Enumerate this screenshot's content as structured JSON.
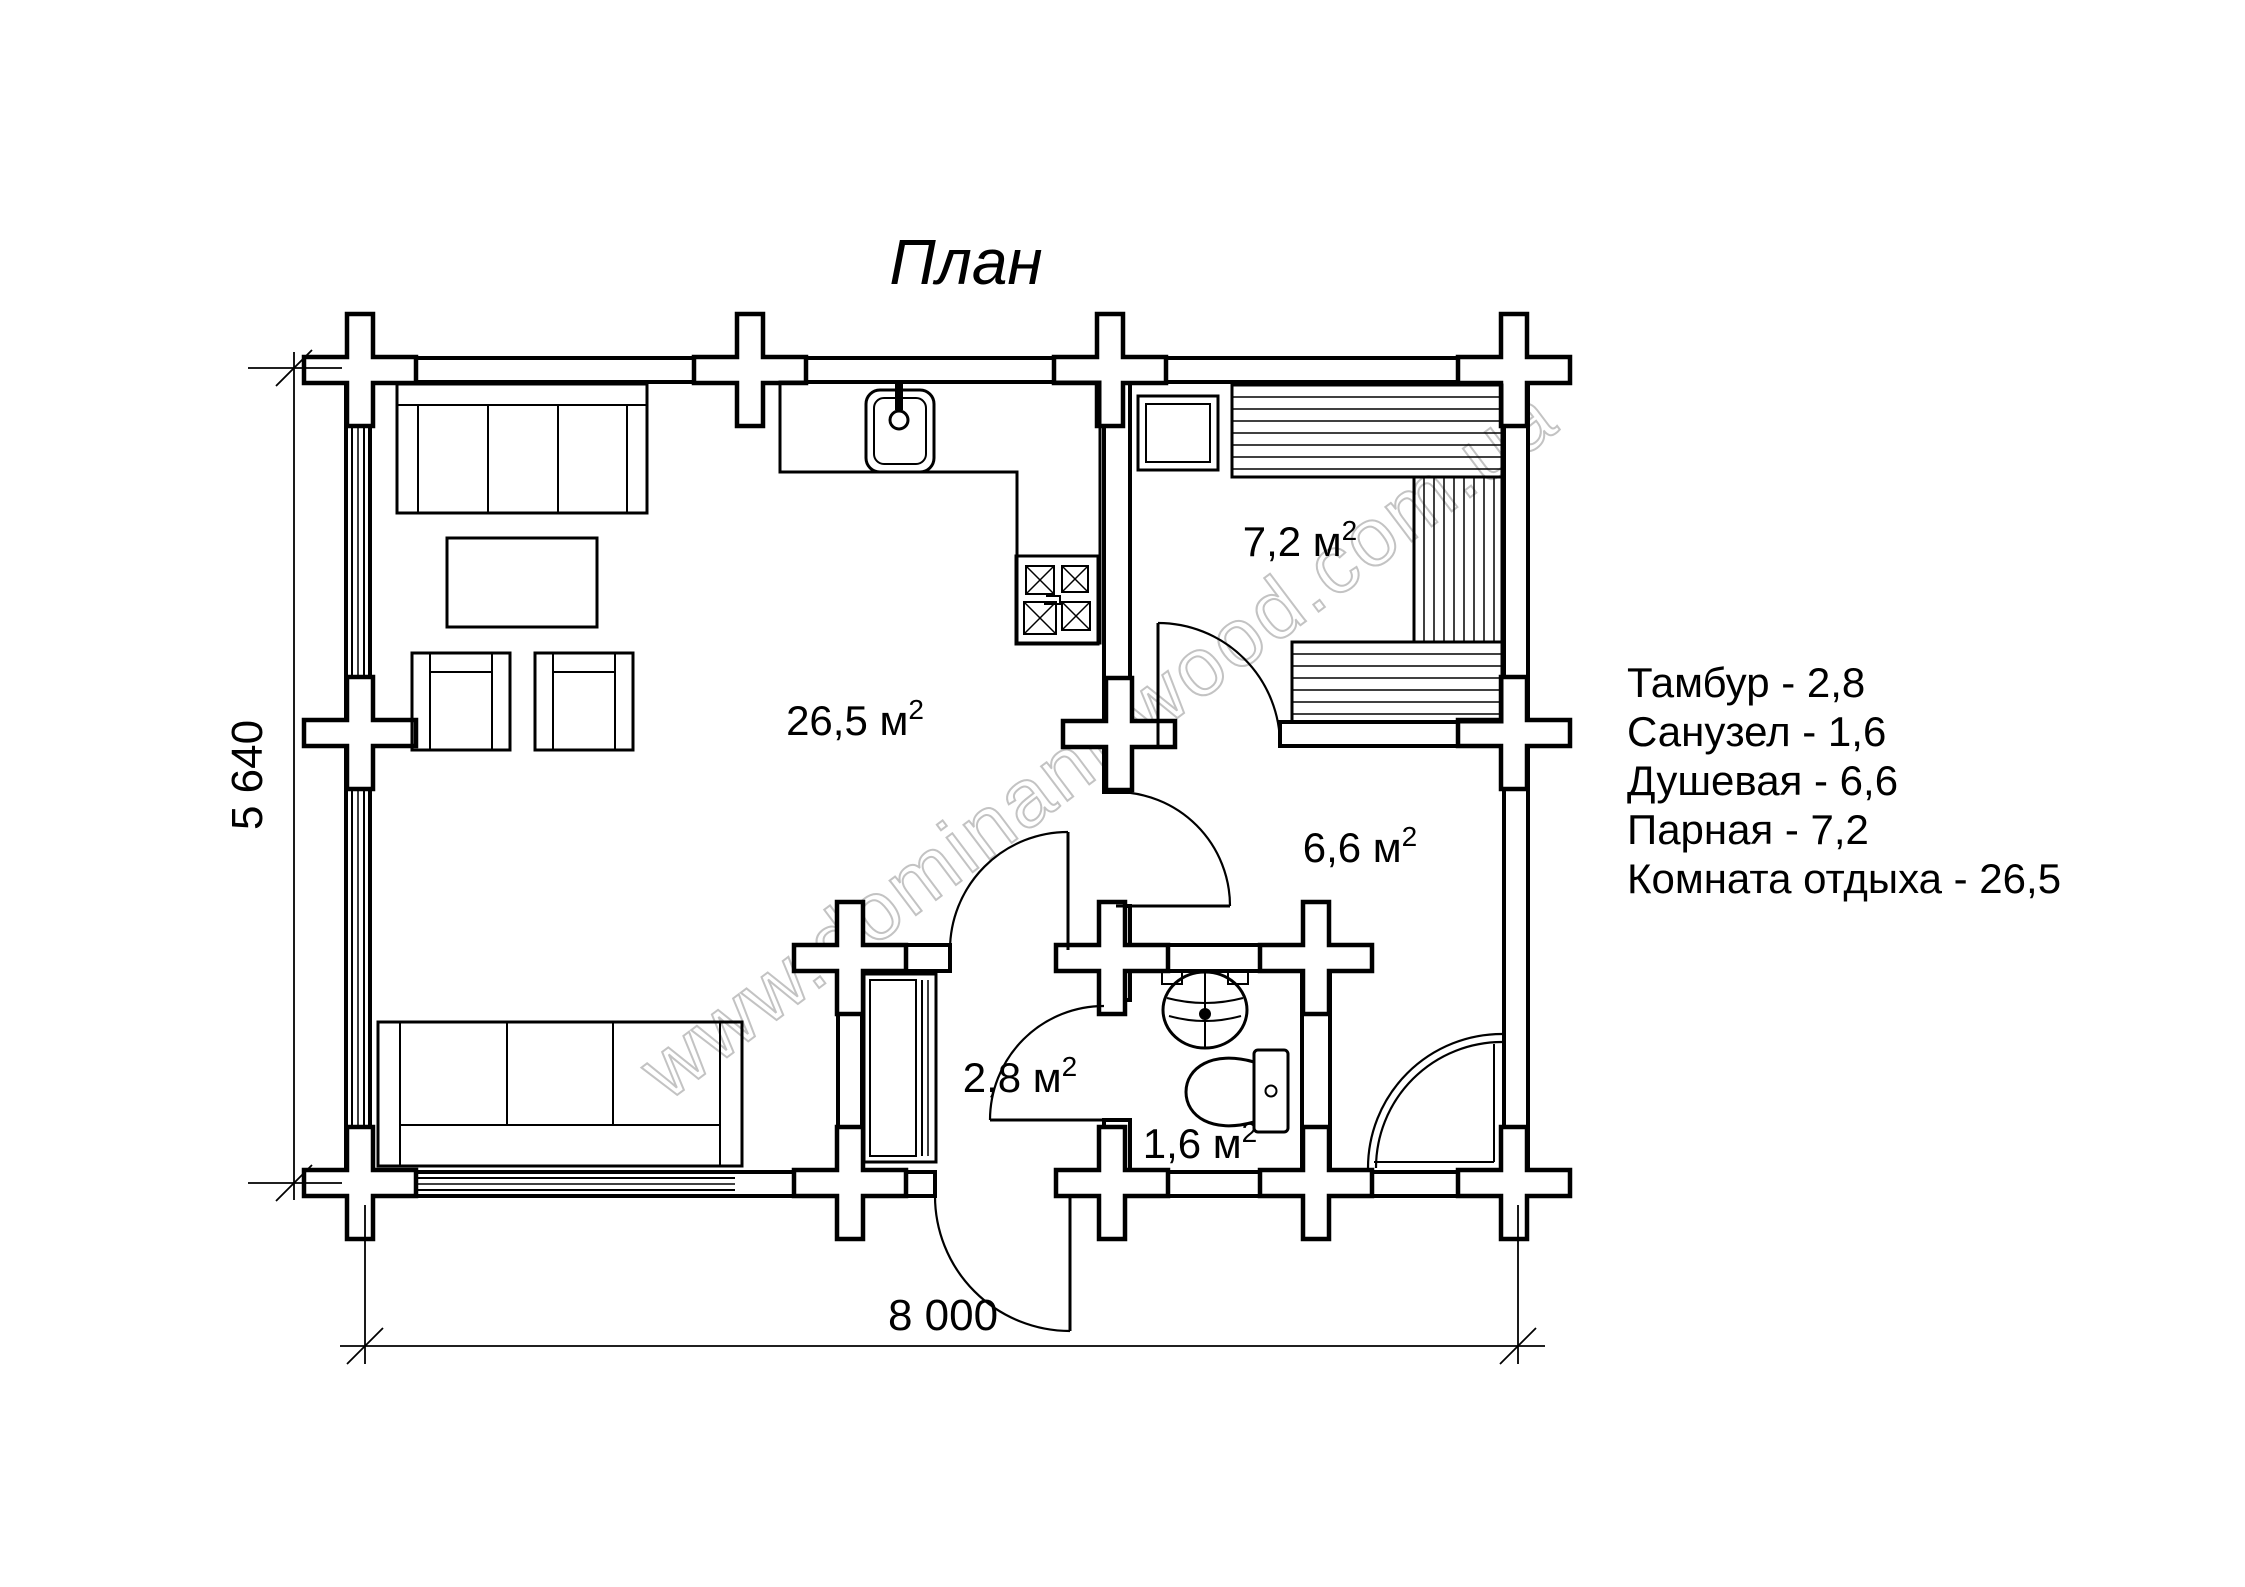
{
  "title": "План",
  "dimensions": {
    "horizontal": "8 000",
    "vertical": "5 640"
  },
  "rooms": {
    "living": {
      "area": "26,5 м",
      "sup": "2"
    },
    "steam": {
      "area": "7,2 м",
      "sup": "2"
    },
    "shower": {
      "area": "6,6 м",
      "sup": "2"
    },
    "vestibule": {
      "area": "2,8 м",
      "sup": "2"
    },
    "wc": {
      "area": "1,6 м",
      "sup": "2"
    }
  },
  "legend": {
    "items": [
      {
        "label": "Тамбур - 2,8"
      },
      {
        "label": "Санузел - 1,6"
      },
      {
        "label": "Душевая - 6,6"
      },
      {
        "label": "Парная - 7,2"
      },
      {
        "label": "Комната отдыха - 26,5"
      }
    ]
  },
  "watermark": "www.dominant-wood.com.ua",
  "colors": {
    "line": "#000000",
    "watermark": "#c3c3c3",
    "background": "#ffffff"
  }
}
